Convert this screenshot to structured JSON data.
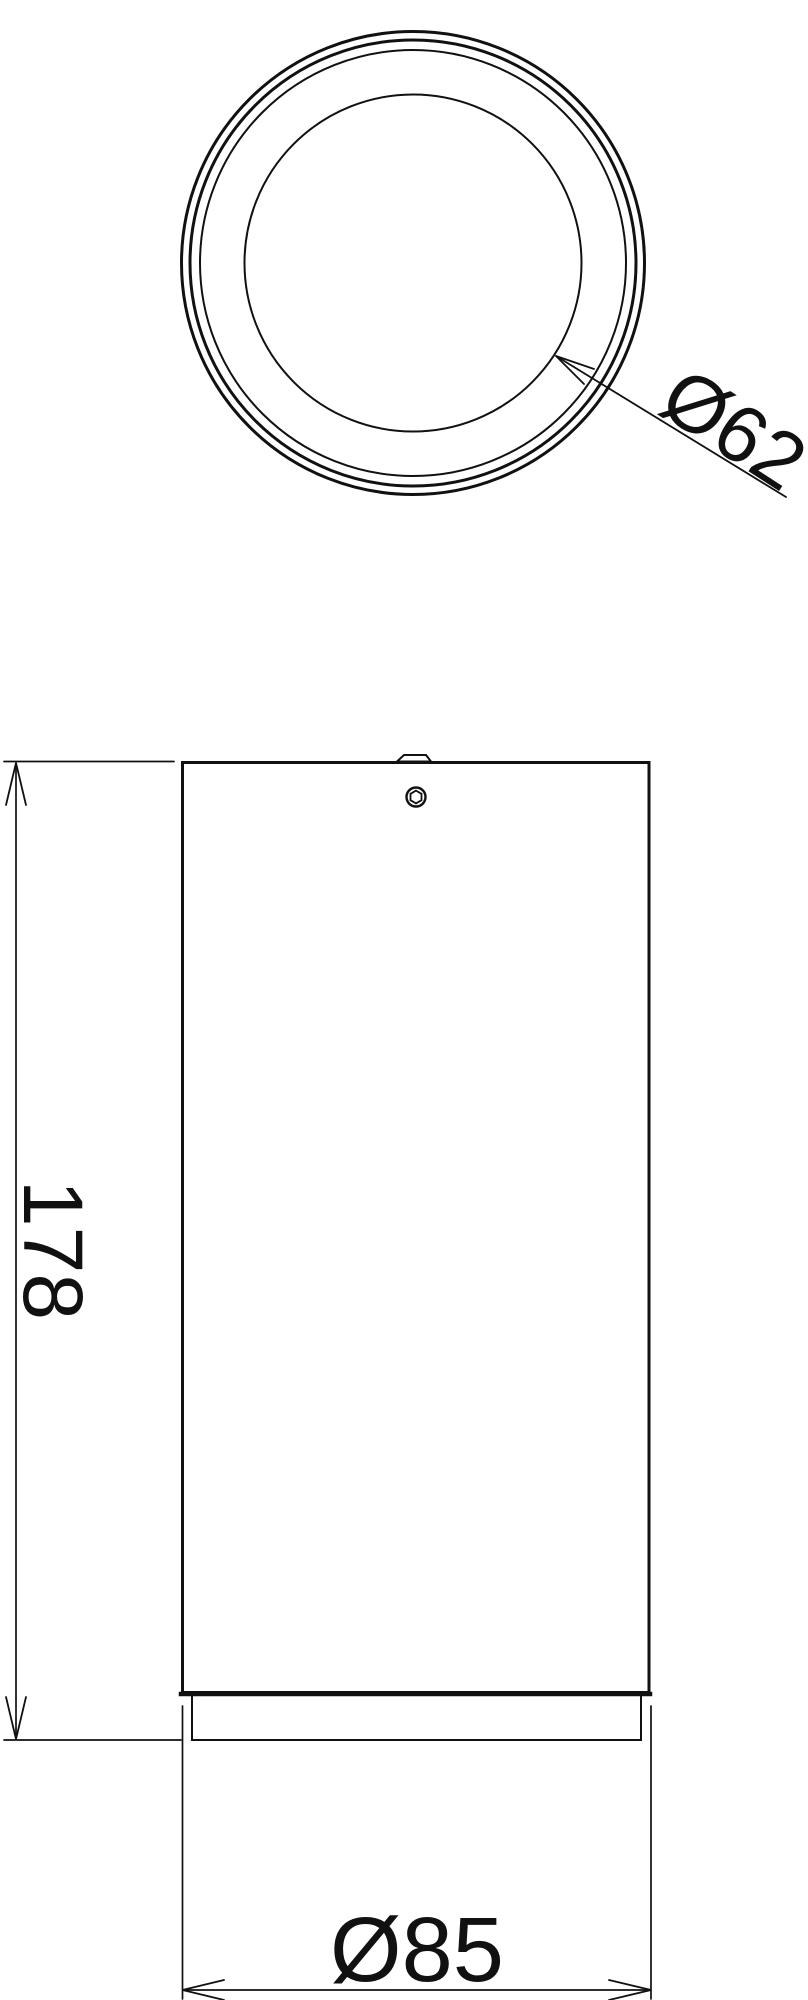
{
  "page": {
    "background": "#ffffff",
    "line_color": "#111111"
  },
  "views": {
    "top_view": {
      "lens_diameter_label": "Ø62"
    },
    "front_view": {
      "height_label": "178",
      "body_diameter_label": "Ø85"
    }
  }
}
